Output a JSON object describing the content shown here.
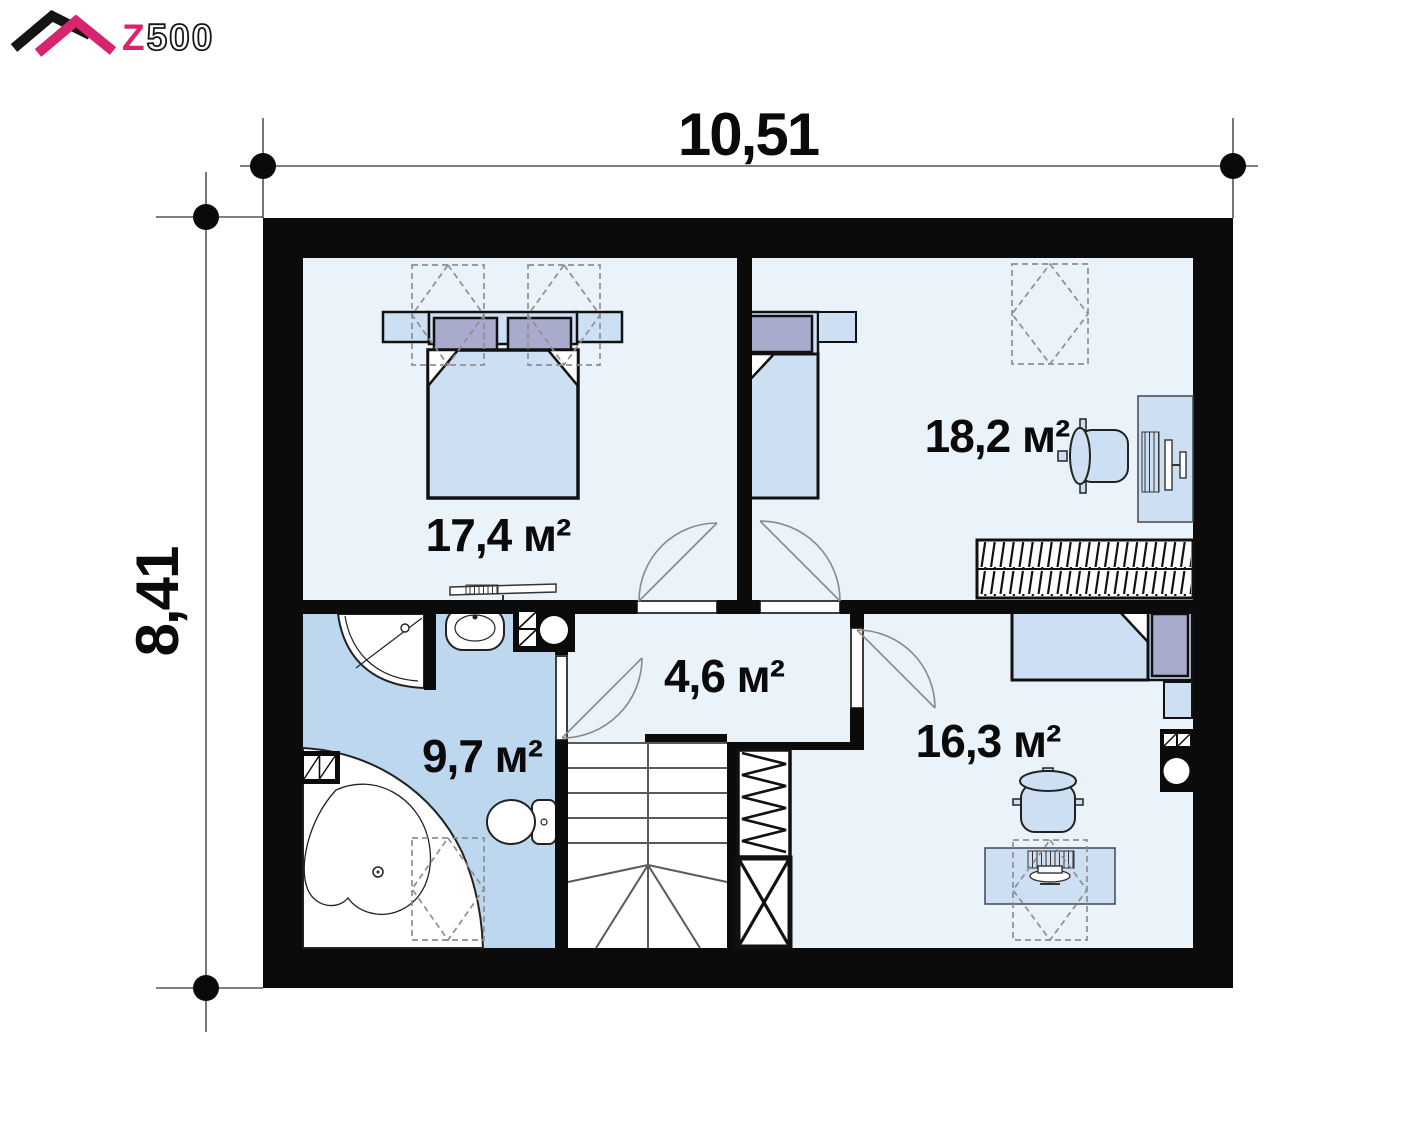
{
  "logo": {
    "z": "Z",
    "rest": "500"
  },
  "dimensions": {
    "width_label": "10,51",
    "height_label": "8,41"
  },
  "rooms": [
    {
      "name": "bedroom-1",
      "area_label": "17,4 м²"
    },
    {
      "name": "bedroom-2",
      "area_label": "18,2 м²"
    },
    {
      "name": "hallway",
      "area_label": "4,6 м²"
    },
    {
      "name": "bathroom",
      "area_label": "9,7 м²"
    },
    {
      "name": "bedroom-3",
      "area_label": "16,3 м²"
    }
  ],
  "colors": {
    "wall": "#0b0b0b",
    "floor": "#eaf2fa",
    "bathroom_floor": "#bdd7ef",
    "furniture_fill": "#ccdff3",
    "pillow_fill": "#a9abcd",
    "logo_pink": "#d6246e"
  }
}
